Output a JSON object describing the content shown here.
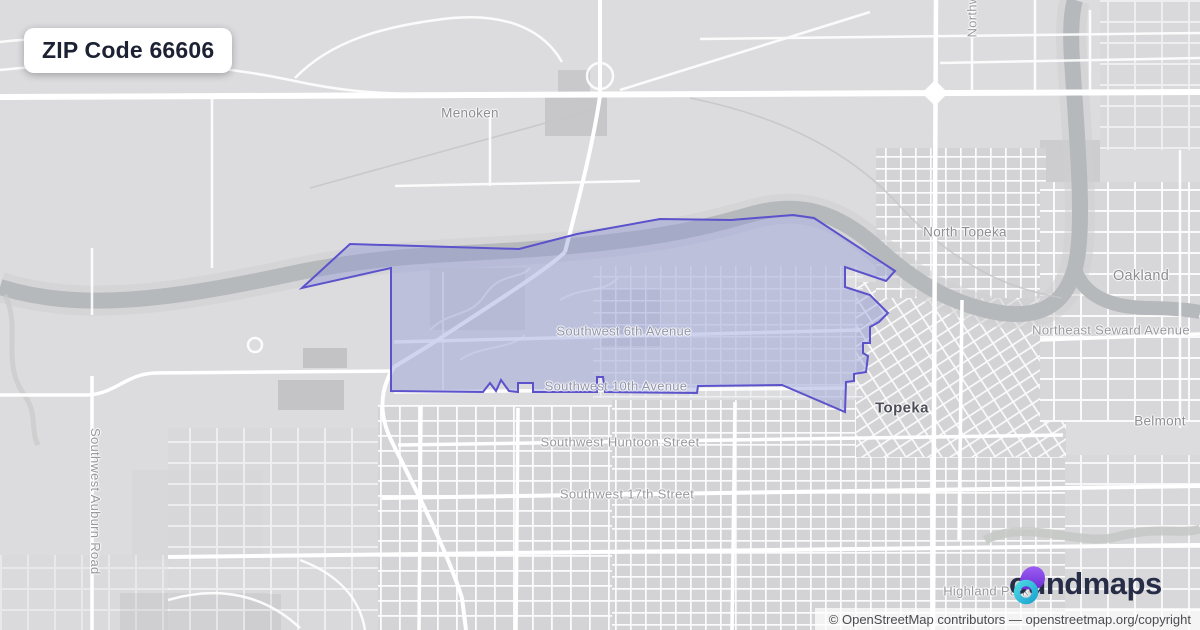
{
  "badge": {
    "title": "ZIP Code 66606"
  },
  "map": {
    "place_labels": {
      "menoken": "Menoken",
      "north_topeka": "North Topeka",
      "oakland": "Oakland",
      "belmont": "Belmont",
      "topeka": "Topeka",
      "highland_park": "Highland Park"
    },
    "street_labels": {
      "sw_6th_avenue": "Southwest 6th Avenue",
      "sw_10th_avenue": "Southwest 10th Avenue",
      "sw_huntoon_street": "Southwest Huntoon Street",
      "sw_17th_street": "Southwest 17th Street",
      "northeast_seward_avenue": "Northeast Seward Avenue",
      "sw_auburn_road": "Southwest Auburn Road",
      "northwest_truncated": "Northw"
    },
    "boundary": {
      "zip_code": "66606",
      "stroke_color": "#5c52cb",
      "fill_color": "rgba(144,152,214,0.42)"
    }
  },
  "logo": {
    "brand": "boundmaps",
    "wordmark": "oundmaps",
    "icon_purple": "#7d3bec",
    "icon_teal": "#38c5d9",
    "text_color": "#272c47"
  },
  "attribution": {
    "text": "© OpenStreetMap contributors — openstreetmap.org/copyright"
  }
}
